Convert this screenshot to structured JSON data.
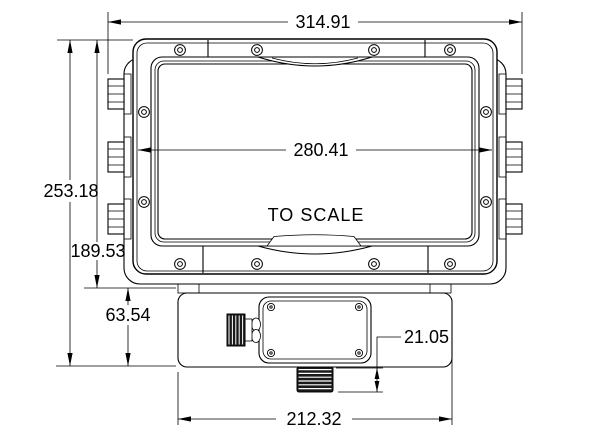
{
  "drawing": {
    "note": "TO SCALE",
    "dimensions": {
      "overall_width": "314.91",
      "bezel_width": "280.41",
      "overall_height": "253.18",
      "enclosure_height": "189.53",
      "base_height": "63.54",
      "base_width": "212.32",
      "conduit_height": "21.05"
    },
    "colors": {
      "line": "#000000",
      "background": "#ffffff",
      "metal_dark": "#1a1a1a"
    }
  }
}
